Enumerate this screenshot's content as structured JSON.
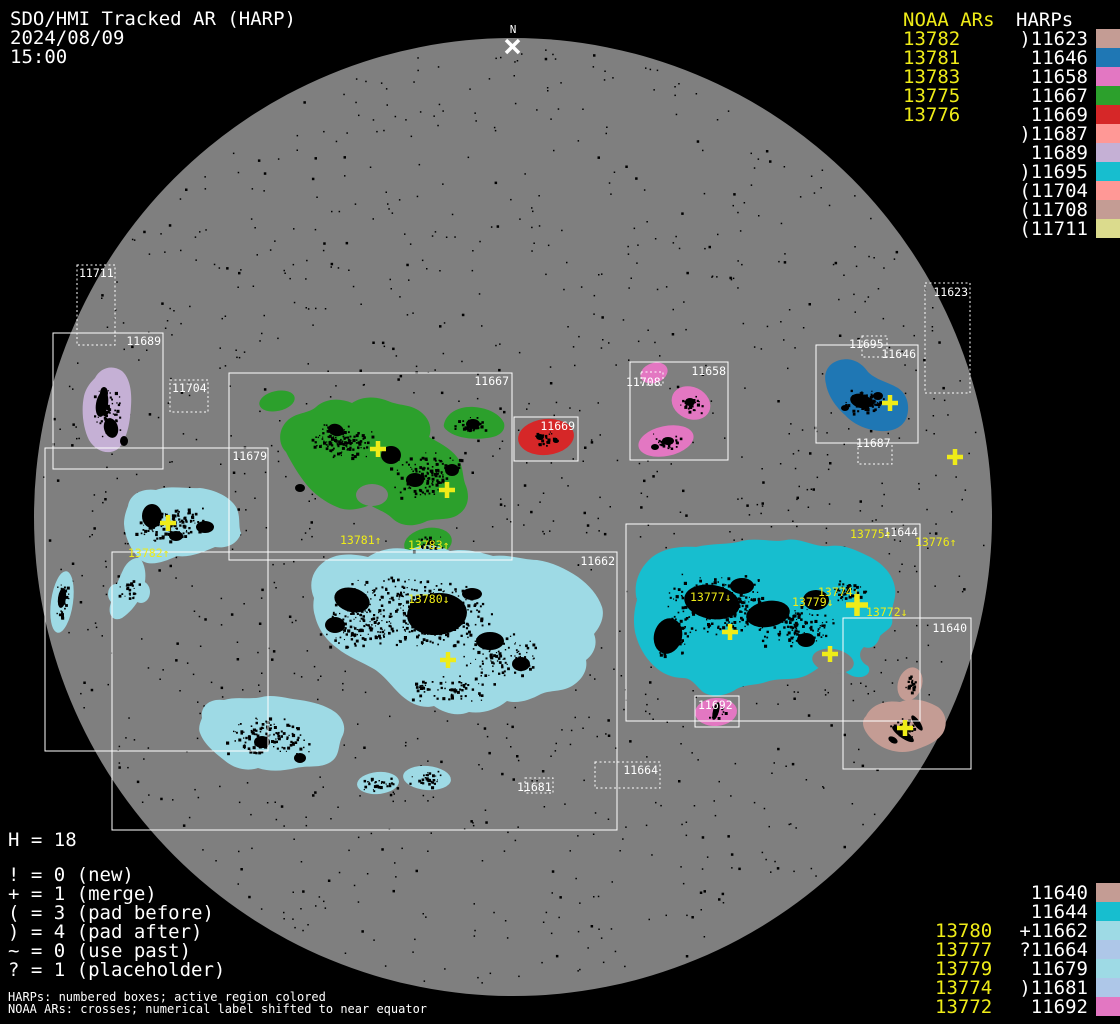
{
  "header": {
    "title": "SDO/HMI Tracked AR (HARP)",
    "date": "2024/08/09",
    "time": "15:00"
  },
  "legend_top": {
    "noaa_header": "NOAA ARs",
    "harps_header": "HARPs",
    "noaa_values": [
      "13782",
      "13781",
      "13783",
      "13775",
      "13776"
    ],
    "harp_rows": [
      {
        "prefix": ")",
        "harp": "11623",
        "color": "#c49c94"
      },
      {
        "prefix": "",
        "harp": "11646",
        "color": "#1f77b4"
      },
      {
        "prefix": "",
        "harp": "11658",
        "color": "#e377c2"
      },
      {
        "prefix": "",
        "harp": "11667",
        "color": "#2ca02c"
      },
      {
        "prefix": "",
        "harp": "11669",
        "color": "#d62728"
      },
      {
        "prefix": ")",
        "harp": "11687",
        "color": "#ff9896"
      },
      {
        "prefix": "",
        "harp": "11689",
        "color": "#c5b0d5"
      },
      {
        "prefix": ")",
        "harp": "11695",
        "color": "#17becf"
      },
      {
        "prefix": "(",
        "harp": "11704",
        "color": "#ff9896"
      },
      {
        "prefix": "(",
        "harp": "11708",
        "color": "#c49c94"
      },
      {
        "prefix": "(",
        "harp": "11711",
        "color": "#dbdb8d"
      }
    ]
  },
  "legend_bottom": {
    "noaa_values": [
      "13780",
      "13777",
      "13779",
      "13774",
      "13772"
    ],
    "noaa_start_row": 2,
    "harp_rows": [
      {
        "prefix": "",
        "harp": "11640",
        "color": "#c49c94"
      },
      {
        "prefix": "",
        "harp": "11644",
        "color": "#17becf"
      },
      {
        "prefix": "+",
        "harp": "11662",
        "color": "#9edae5"
      },
      {
        "prefix": "?",
        "harp": "11664",
        "color": "#aec7e8"
      },
      {
        "prefix": "",
        "harp": "11679",
        "color": "#9edae5"
      },
      {
        "prefix": ")",
        "harp": "11681",
        "color": "#aec7e8"
      },
      {
        "prefix": "",
        "harp": "11692",
        "color": "#e377c2"
      }
    ]
  },
  "symbol_legend": {
    "h_count": "H = 18",
    "lines": [
      "! = 0 (new)",
      "+ = 1 (merge)",
      "( = 3 (pad before)",
      ") = 4 (pad after)",
      "~ = 0 (use past)",
      "? = 1 (placeholder)"
    ]
  },
  "footnotes": [
    "HARPs: numbered boxes; active region colored",
    "NOAA ARs: crosses; numerical label shifted to near equator"
  ],
  "disk": {
    "north_label": "N",
    "harp_boxes": [
      {
        "id": "11711",
        "style": "dotted"
      },
      {
        "id": "11689",
        "style": "solid"
      },
      {
        "id": "11704",
        "style": "dotted"
      },
      {
        "id": "11679",
        "style": "solid"
      },
      {
        "id": "11667",
        "style": "solid"
      },
      {
        "id": "11669",
        "style": "solid"
      },
      {
        "id": "11658",
        "style": "solid"
      },
      {
        "id": "11708",
        "style": "dotted"
      },
      {
        "id": "11623",
        "style": "dotted"
      },
      {
        "id": "11695",
        "style": "dotted"
      },
      {
        "id": "11646",
        "style": "solid"
      },
      {
        "id": "11687",
        "style": "dotted"
      },
      {
        "id": "11644",
        "style": "solid"
      },
      {
        "id": "11640",
        "style": "solid"
      },
      {
        "id": "11692",
        "style": "solid"
      },
      {
        "id": "11662",
        "style": "solid"
      },
      {
        "id": "11664",
        "style": "dotted"
      },
      {
        "id": "11681",
        "style": "dotted"
      }
    ],
    "noaa_disk_labels": [
      "13782↑",
      "13781↑",
      "13783↑",
      "13780↓",
      "13777↓",
      "13779↓",
      "13774↓",
      "13772↓",
      "13775↑",
      "13776↑"
    ],
    "noaa_crosses_count": 10,
    "region_colors": {
      "11623": "#c49c94",
      "11640": "#c49c94",
      "11644": "#17becf",
      "11646": "#1f77b4",
      "11658": "#e377c2",
      "11662": "#9edae5",
      "11664": "#aec7e8",
      "11667": "#2ca02c",
      "11669": "#d62728",
      "11679": "#9edae5",
      "11681": "#aec7e8",
      "11687": "#ff9896",
      "11689": "#c5b0d5",
      "11692": "#e377c2",
      "11695": "#17becf",
      "11704": "#ff9896",
      "11708": "#c49c94",
      "11711": "#dbdb8d"
    },
    "colors": {
      "background": "#000000",
      "disk": "#7f7f7f",
      "box_line": "#ffffff",
      "noaa_yellow": "#efec18",
      "label_white": "#ffffff"
    }
  }
}
